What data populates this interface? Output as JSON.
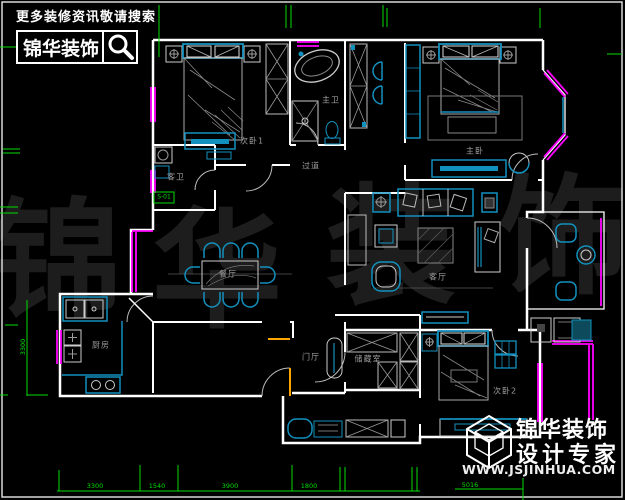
{
  "header": {
    "tagline": "更多装修资讯敬请搜索",
    "brand": "锦华装饰"
  },
  "watermark": {
    "c1": "锦",
    "c2": "华",
    "c3": "装",
    "c4": "饰"
  },
  "rooms": {
    "bedroom1": "次卧1",
    "master_bath": "主卫",
    "guest_bath": "客卫",
    "corridor": "过道",
    "master_bedroom": "主卧",
    "living": "客厅",
    "dining": "餐厅",
    "kitchen": "厨房",
    "foyer": "门厅",
    "storage": "储藏室",
    "bedroom2": "次卧2"
  },
  "marker": {
    "label": "S-01"
  },
  "dims": {
    "bottom": [
      "3300",
      "1540",
      "3900",
      "1800"
    ],
    "bottom_right": "5016",
    "left": "3300"
  },
  "footer": {
    "brand_line1": "锦华装饰",
    "brand_line2": "设计专家",
    "website": "WWW.JSJINHUA.COM"
  },
  "colors": {
    "furniture_cyan": "#1391BE",
    "window_magenta": "#FF00FF",
    "dimension_green": "#00DD00",
    "wall_white": "#FFFFFF",
    "door_orange": "#FFA500"
  }
}
